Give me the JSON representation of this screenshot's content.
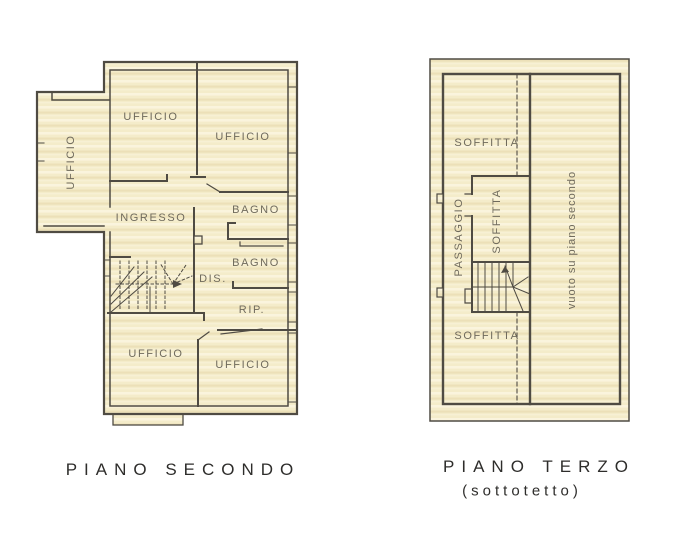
{
  "page": {
    "type": "floor-plan-scan",
    "background": "#ffffff"
  },
  "colors": {
    "plan_fill": "#f4ecca",
    "plan_fill_light_streak": "#faf4dd",
    "plan_fill_dark_streak": "#ece0b8",
    "wall_line": "#4f4b43",
    "room_label_text": "#6f6a5c",
    "caption_text": "#2e2d2b"
  },
  "left_plan": {
    "caption": "PIANO SECONDO",
    "rooms": [
      {
        "id": "ufficio-wing",
        "label": "UFFICIO",
        "orientation": "vertical"
      },
      {
        "id": "ufficio-top-center",
        "label": "UFFICIO",
        "orientation": "horizontal"
      },
      {
        "id": "ufficio-top-right",
        "label": "UFFICIO",
        "orientation": "horizontal"
      },
      {
        "id": "ingresso",
        "label": "INGRESSO",
        "orientation": "horizontal"
      },
      {
        "id": "bagno-upper",
        "label": "BAGNO",
        "orientation": "horizontal"
      },
      {
        "id": "bagno-lower",
        "label": "BAGNO",
        "orientation": "horizontal"
      },
      {
        "id": "disimpegno",
        "label": "DIS.",
        "orientation": "horizontal"
      },
      {
        "id": "ripostiglio",
        "label": "RIP.",
        "orientation": "horizontal"
      },
      {
        "id": "ufficio-bottom-left",
        "label": "UFFICIO",
        "orientation": "horizontal"
      },
      {
        "id": "ufficio-bottom-right",
        "label": "UFFICIO",
        "orientation": "horizontal"
      }
    ]
  },
  "right_plan": {
    "caption_line1": "PIANO TERZO",
    "caption_line2": "(sottotetto)",
    "rooms": [
      {
        "id": "soffitta-top",
        "label": "SOFFITTA",
        "orientation": "horizontal"
      },
      {
        "id": "passaggio",
        "label": "PASSAGGIO",
        "orientation": "vertical"
      },
      {
        "id": "soffitta-middle",
        "label": "SOFFITTA",
        "orientation": "vertical"
      },
      {
        "id": "soffitta-bottom",
        "label": "SOFFITTA",
        "orientation": "horizontal"
      },
      {
        "id": "vuoto",
        "label": "vuoto su piano secondo",
        "orientation": "vertical"
      }
    ]
  }
}
